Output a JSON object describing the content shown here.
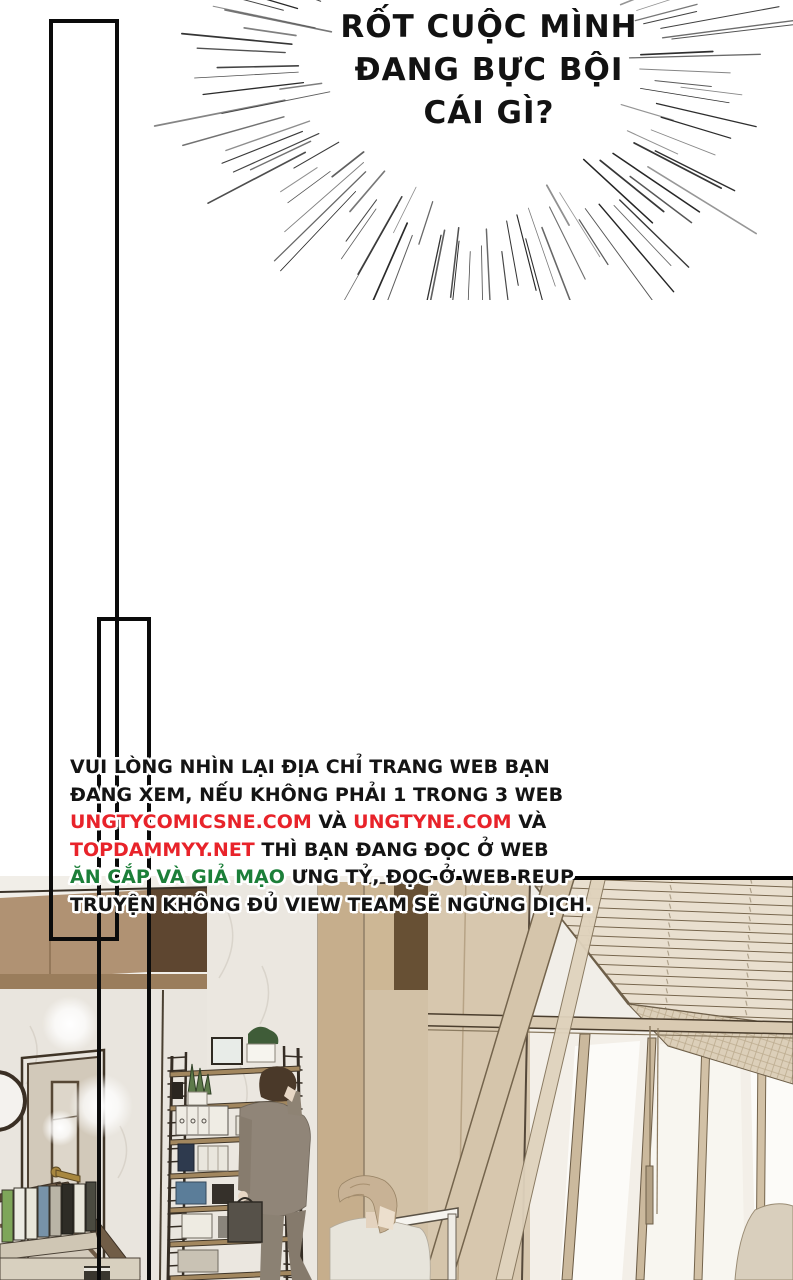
{
  "speech": {
    "l1": "RỐT CUỘC MÌNH",
    "l2": "ĐANG BỰC BỘI",
    "l3": "CÁI GÌ?"
  },
  "notice": {
    "l1": "VUI LÒNG NHÌN LẠI ĐỊA CHỈ TRANG WEB BẠN",
    "l2": "ĐANG XEM, NẾU KHÔNG PHẢI 1 TRONG 3 WEB",
    "l3a": "UNGTYCOMICSNE.COM",
    "l3b": " VÀ ",
    "l3c": "UNGTYNE.COM",
    "l3d": " VÀ",
    "l4a": "TOPDAMMYY.NET",
    "l4b": " THÌ BẠN ĐANG ĐỌC Ở WEB",
    "l5a": "ĂN CẮP VÀ GIẢ MẠO",
    "l5b": " ƯNG TỶ, ĐỌC Ở WEB REUP",
    "l6": "TRUYỆN KHÔNG ĐỦ VIEW TEAM SẼ NGỪNG DỊCH."
  },
  "colors": {
    "link_red": "#e8232a",
    "warn_green": "#1c7f39",
    "ink": "#141414"
  },
  "scene": {
    "description": "3D office interior: dark wood panelled wall, white marble wall with a beige door, ladder-style bookshelf with plants and binders, man in a taupe suit on the phone carrying a briefcase, young man with light brown hair in a pale shirt, slanted venetian blinds and glass partition on the right, stair railing with binders at lower left"
  }
}
